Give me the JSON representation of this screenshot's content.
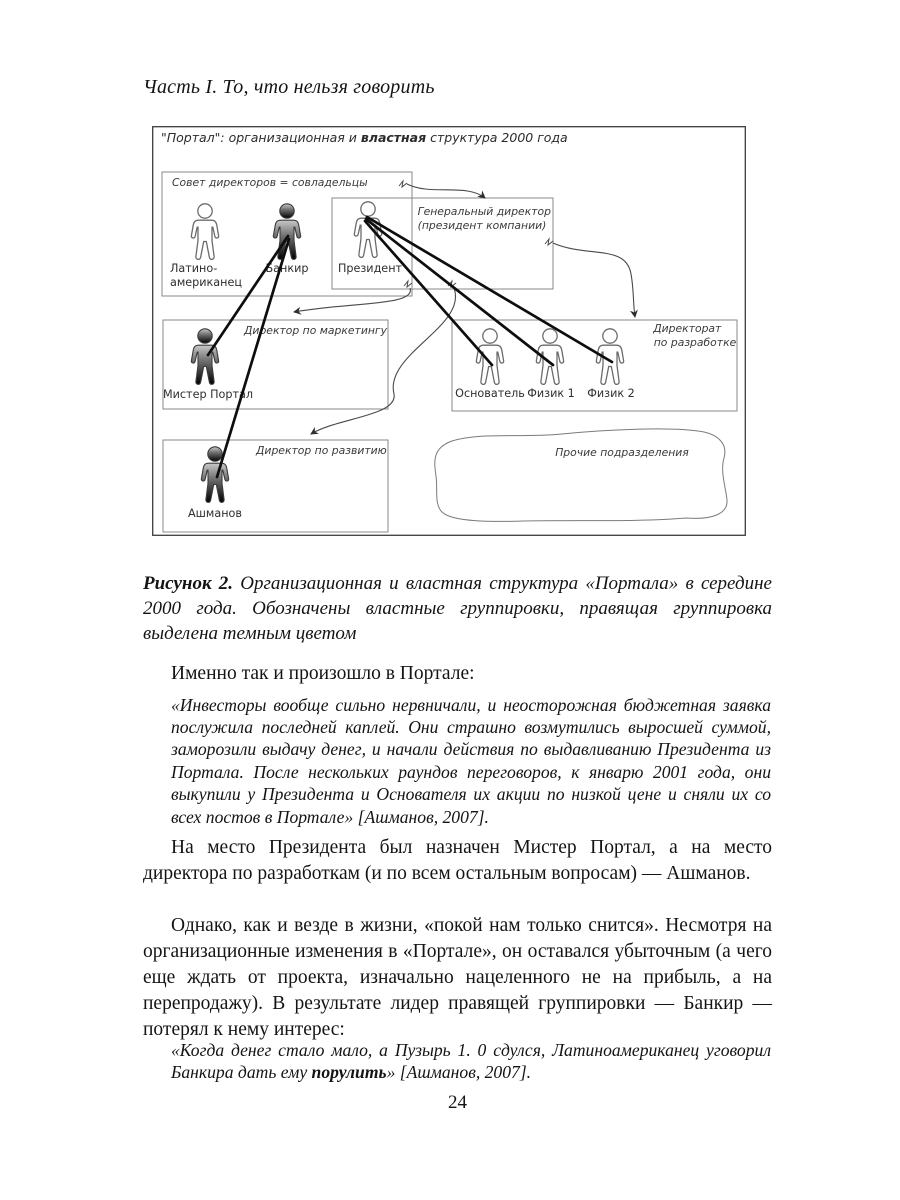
{
  "page": {
    "running_head": "Часть I. То, что нельзя говорить",
    "page_number": "24"
  },
  "diagram": {
    "title_pre": "\"Портал\": организационная и ",
    "title_bold": "властная",
    "title_post": " структура 2000 года",
    "boxes": {
      "council": "Совет директоров = совладельцы",
      "ceo_line1": "Генеральный директор",
      "ceo_line2": "(президент компании)",
      "marketing": "Директор по маркетингу",
      "rnd_line1": "Директорат",
      "rnd_line2": "по разработке",
      "development": "Директор по развитию",
      "other": "Прочие подразделения"
    },
    "figures": {
      "latino_line1": "Латино-",
      "latino_line2": "американец",
      "banker": "Банкир",
      "president": "Президент",
      "mr_portal": "Мистер Портал",
      "founder": "Основатель",
      "physicist1": "Физик 1",
      "physicist2": "Физик 2",
      "ashmanov": "Ашманов"
    }
  },
  "caption": {
    "label": "Рисунок 2.",
    "text": "Организационная и властная структура «Портала» в середине 2000 года. Обозначены властные группировки, правящая группировка выделена темным цветом"
  },
  "body": {
    "p1": "Именно так и произошло в Портале:",
    "quote1": "«Инвесторы вообще сильно нервничали, и неосторожная бюджетная заявка послужила последней каплей. Они страшно возмутились выросшей суммой, заморозили выдачу денег, и начали действия по выдавливанию Президента из Портала. После нескольких раундов переговоров, к январю 2001 года, они выкупили у Президента и Основателя их акции по низкой цене и сняли их со всех постов в Портале» [Ашманов, 2007].",
    "p2": "На место Президента был назначен Мистер Портал, а на место директора по разработкам (и по всем остальным вопросам) — Ашманов.",
    "p3": "Однако, как и везде в жизни, «покой нам только снится». Несмотря на организационные изменения в «Портале», он оставался убыточным (а чего еще ждать от проекта, изначально нацеленного не на прибыль, а на перепродажу). В результате лидер правящей группировки — Банкир — потерял к нему интерес:",
    "quote2_pre": "«Когда денег стало мало, а Пузырь 1. 0 сдулся, Латиноамериканец уговорил Банкира дать ему ",
    "quote2_bold": "порулить",
    "quote2_post": "» [Ашманов, 2007]."
  }
}
